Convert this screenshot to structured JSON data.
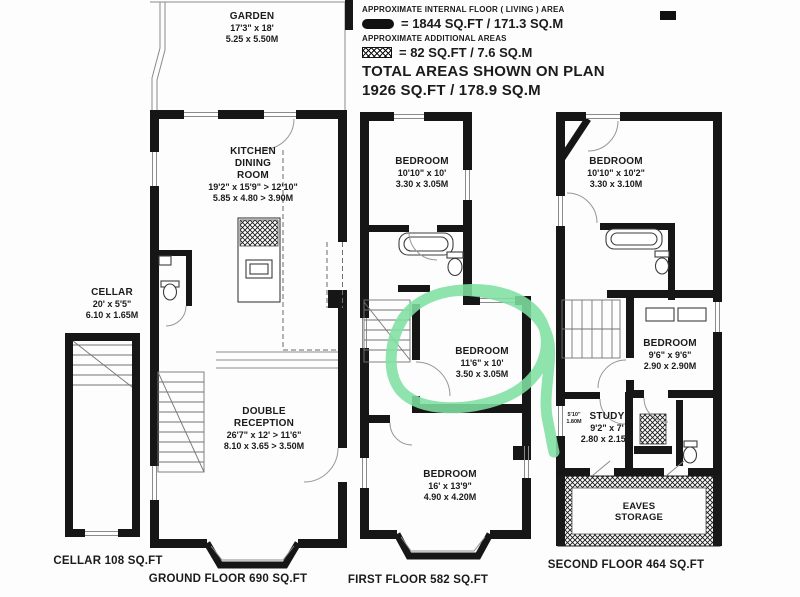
{
  "legend": {
    "internal_label": "APPROXIMATE INTERNAL FLOOR ( LIVING ) AREA",
    "internal_value": "= 1844 SQ.FT / 171.3 SQ.M",
    "additional_label": "APPROXIMATE ADDITIONAL AREAS",
    "additional_value": "= 82 SQ.FT / 7.6 SQ.M",
    "total_line1": "TOTAL AREAS SHOWN ON PLAN",
    "total_line2": "1926 SQ.FT / 178.9 SQ.M"
  },
  "rooms": {
    "garden": {
      "name": "GARDEN",
      "imperial": "17'3\" x 18'",
      "metric": "5.25 x 5.50M"
    },
    "kitchen_dining": {
      "name": "KITCHEN\nDINING\nROOM",
      "imperial": "19'2\" x 15'9\" > 12'10\"",
      "metric": "5.85 x 4.80 > 3.90M"
    },
    "cellar": {
      "name": "CELLAR",
      "imperial": "20' x 5'5\"",
      "metric": "6.10 x 1.65M"
    },
    "double_reception": {
      "name": "DOUBLE\nRECEPTION",
      "imperial": "26'7\" x 12' > 11'6\"",
      "metric": "8.10 x 3.65 > 3.50M"
    },
    "ff_bedroom_rear": {
      "name": "BEDROOM",
      "imperial": "10'10\" x 10'",
      "metric": "3.30 x 3.05M"
    },
    "ff_bedroom_middle": {
      "name": "BEDROOM",
      "imperial": "11'6\" x 10'",
      "metric": "3.50 x 3.05M"
    },
    "ff_bedroom_front": {
      "name": "BEDROOM",
      "imperial": "16' x 13'9\"",
      "metric": "4.90 x 4.20M"
    },
    "sf_bedroom_rear": {
      "name": "BEDROOM",
      "imperial": "10'10\" x 10'2\"",
      "metric": "3.30 x 3.10M"
    },
    "sf_bedroom_middle": {
      "name": "BEDROOM",
      "imperial": "9'6\" x 9'6\"",
      "metric": "2.90 x 2.90M"
    },
    "study": {
      "name": "STUDY",
      "imperial": "9'2\" x 7'",
      "metric": "2.80 x 2.15M"
    },
    "eaves": {
      "name": "EAVES\nSTORAGE"
    },
    "height_marker": {
      "line1": "5'10\"",
      "line2": "1.80M"
    }
  },
  "captions": {
    "cellar": "CELLAR 108 SQ.FT",
    "ground": "GROUND FLOOR 690 SQ.FT",
    "first": "FIRST FLOOR 582 SQ.FT",
    "second": "SECOND FLOOR 464 SQ.FT"
  },
  "highlight": {
    "color": "#7fe0a2"
  }
}
